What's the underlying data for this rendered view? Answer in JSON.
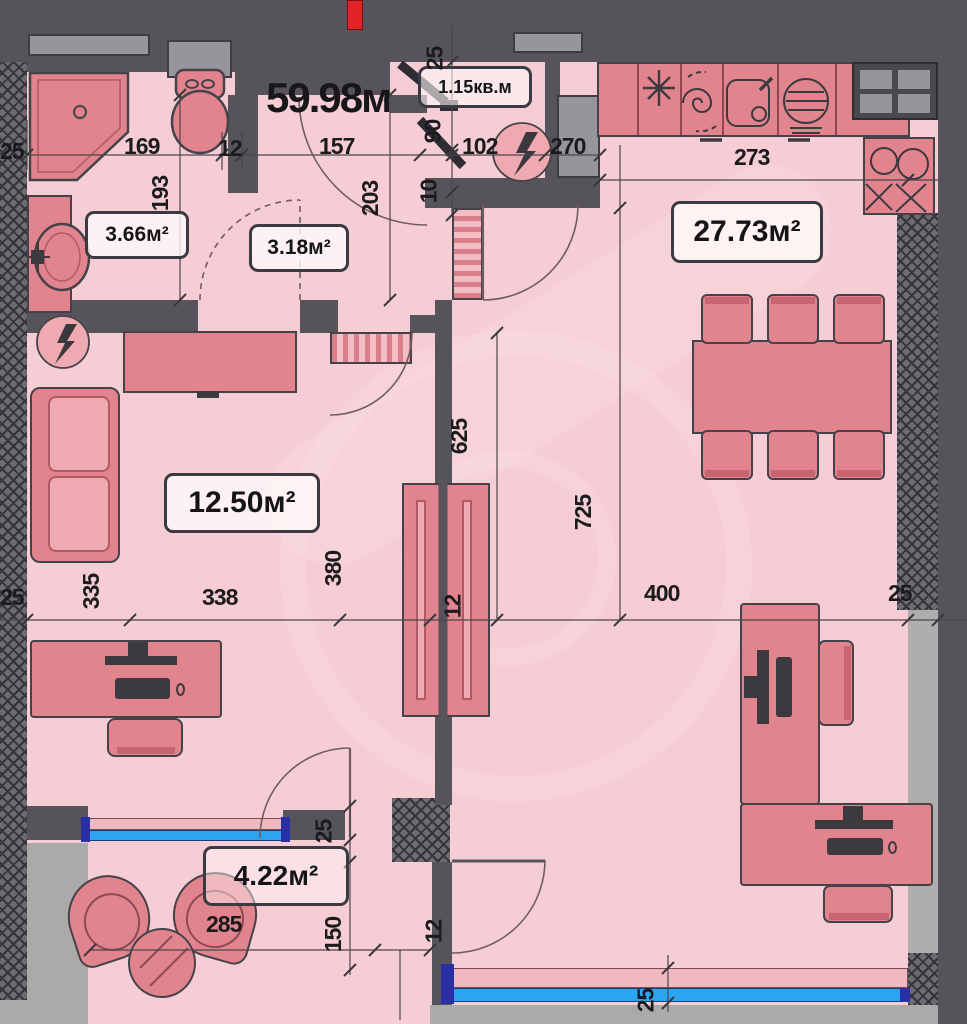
{
  "labels": {
    "total": "59.98м",
    "closet": "1.15кв.м",
    "bathroom": "3.66м²",
    "hall": "3.18м²",
    "living_kitchen": "27.73м²",
    "bedroom": "12.50м²",
    "balcony": "4.22м²"
  },
  "dims": [
    {
      "v": "25"
    },
    {
      "v": "169"
    },
    {
      "v": "12"
    },
    {
      "v": "157"
    },
    {
      "v": "25"
    },
    {
      "v": "90"
    },
    {
      "v": "10"
    },
    {
      "v": "102"
    },
    {
      "v": "270"
    },
    {
      "v": "193"
    },
    {
      "v": "203"
    },
    {
      "v": "273"
    },
    {
      "v": "25"
    },
    {
      "v": "335"
    },
    {
      "v": "338"
    },
    {
      "v": "380"
    },
    {
      "v": "12"
    },
    {
      "v": "625"
    },
    {
      "v": "725"
    },
    {
      "v": "400"
    },
    {
      "v": "25"
    },
    {
      "v": "25"
    },
    {
      "v": "150"
    },
    {
      "v": "285"
    },
    {
      "v": "12"
    },
    {
      "v": "25"
    }
  ],
  "fixtures": [
    "shower",
    "toilet",
    "washbasin",
    "electrical-panel",
    "washing-machine",
    "kitchen-sink",
    "oven",
    "cooktop",
    "corner-cabinet",
    "dining-table",
    "chair",
    "sofa",
    "wardrobe",
    "desk",
    "office-chair",
    "armchair",
    "coffee-table",
    "louver-door",
    "window-band",
    "door-swing"
  ],
  "colors": {
    "wall": "#56545a",
    "extGray": "#b0aeac",
    "grayLight": "#acaaa8",
    "grayMid": "#97959b",
    "floor": "#f6cdd4",
    "furn": "#e2848e",
    "furnLight": "#efaab1",
    "outline": "#45424a",
    "blue": "#2ba5ef",
    "navy": "#2b2fa5",
    "red": "#e12428",
    "ink": "#1b1b1d"
  }
}
